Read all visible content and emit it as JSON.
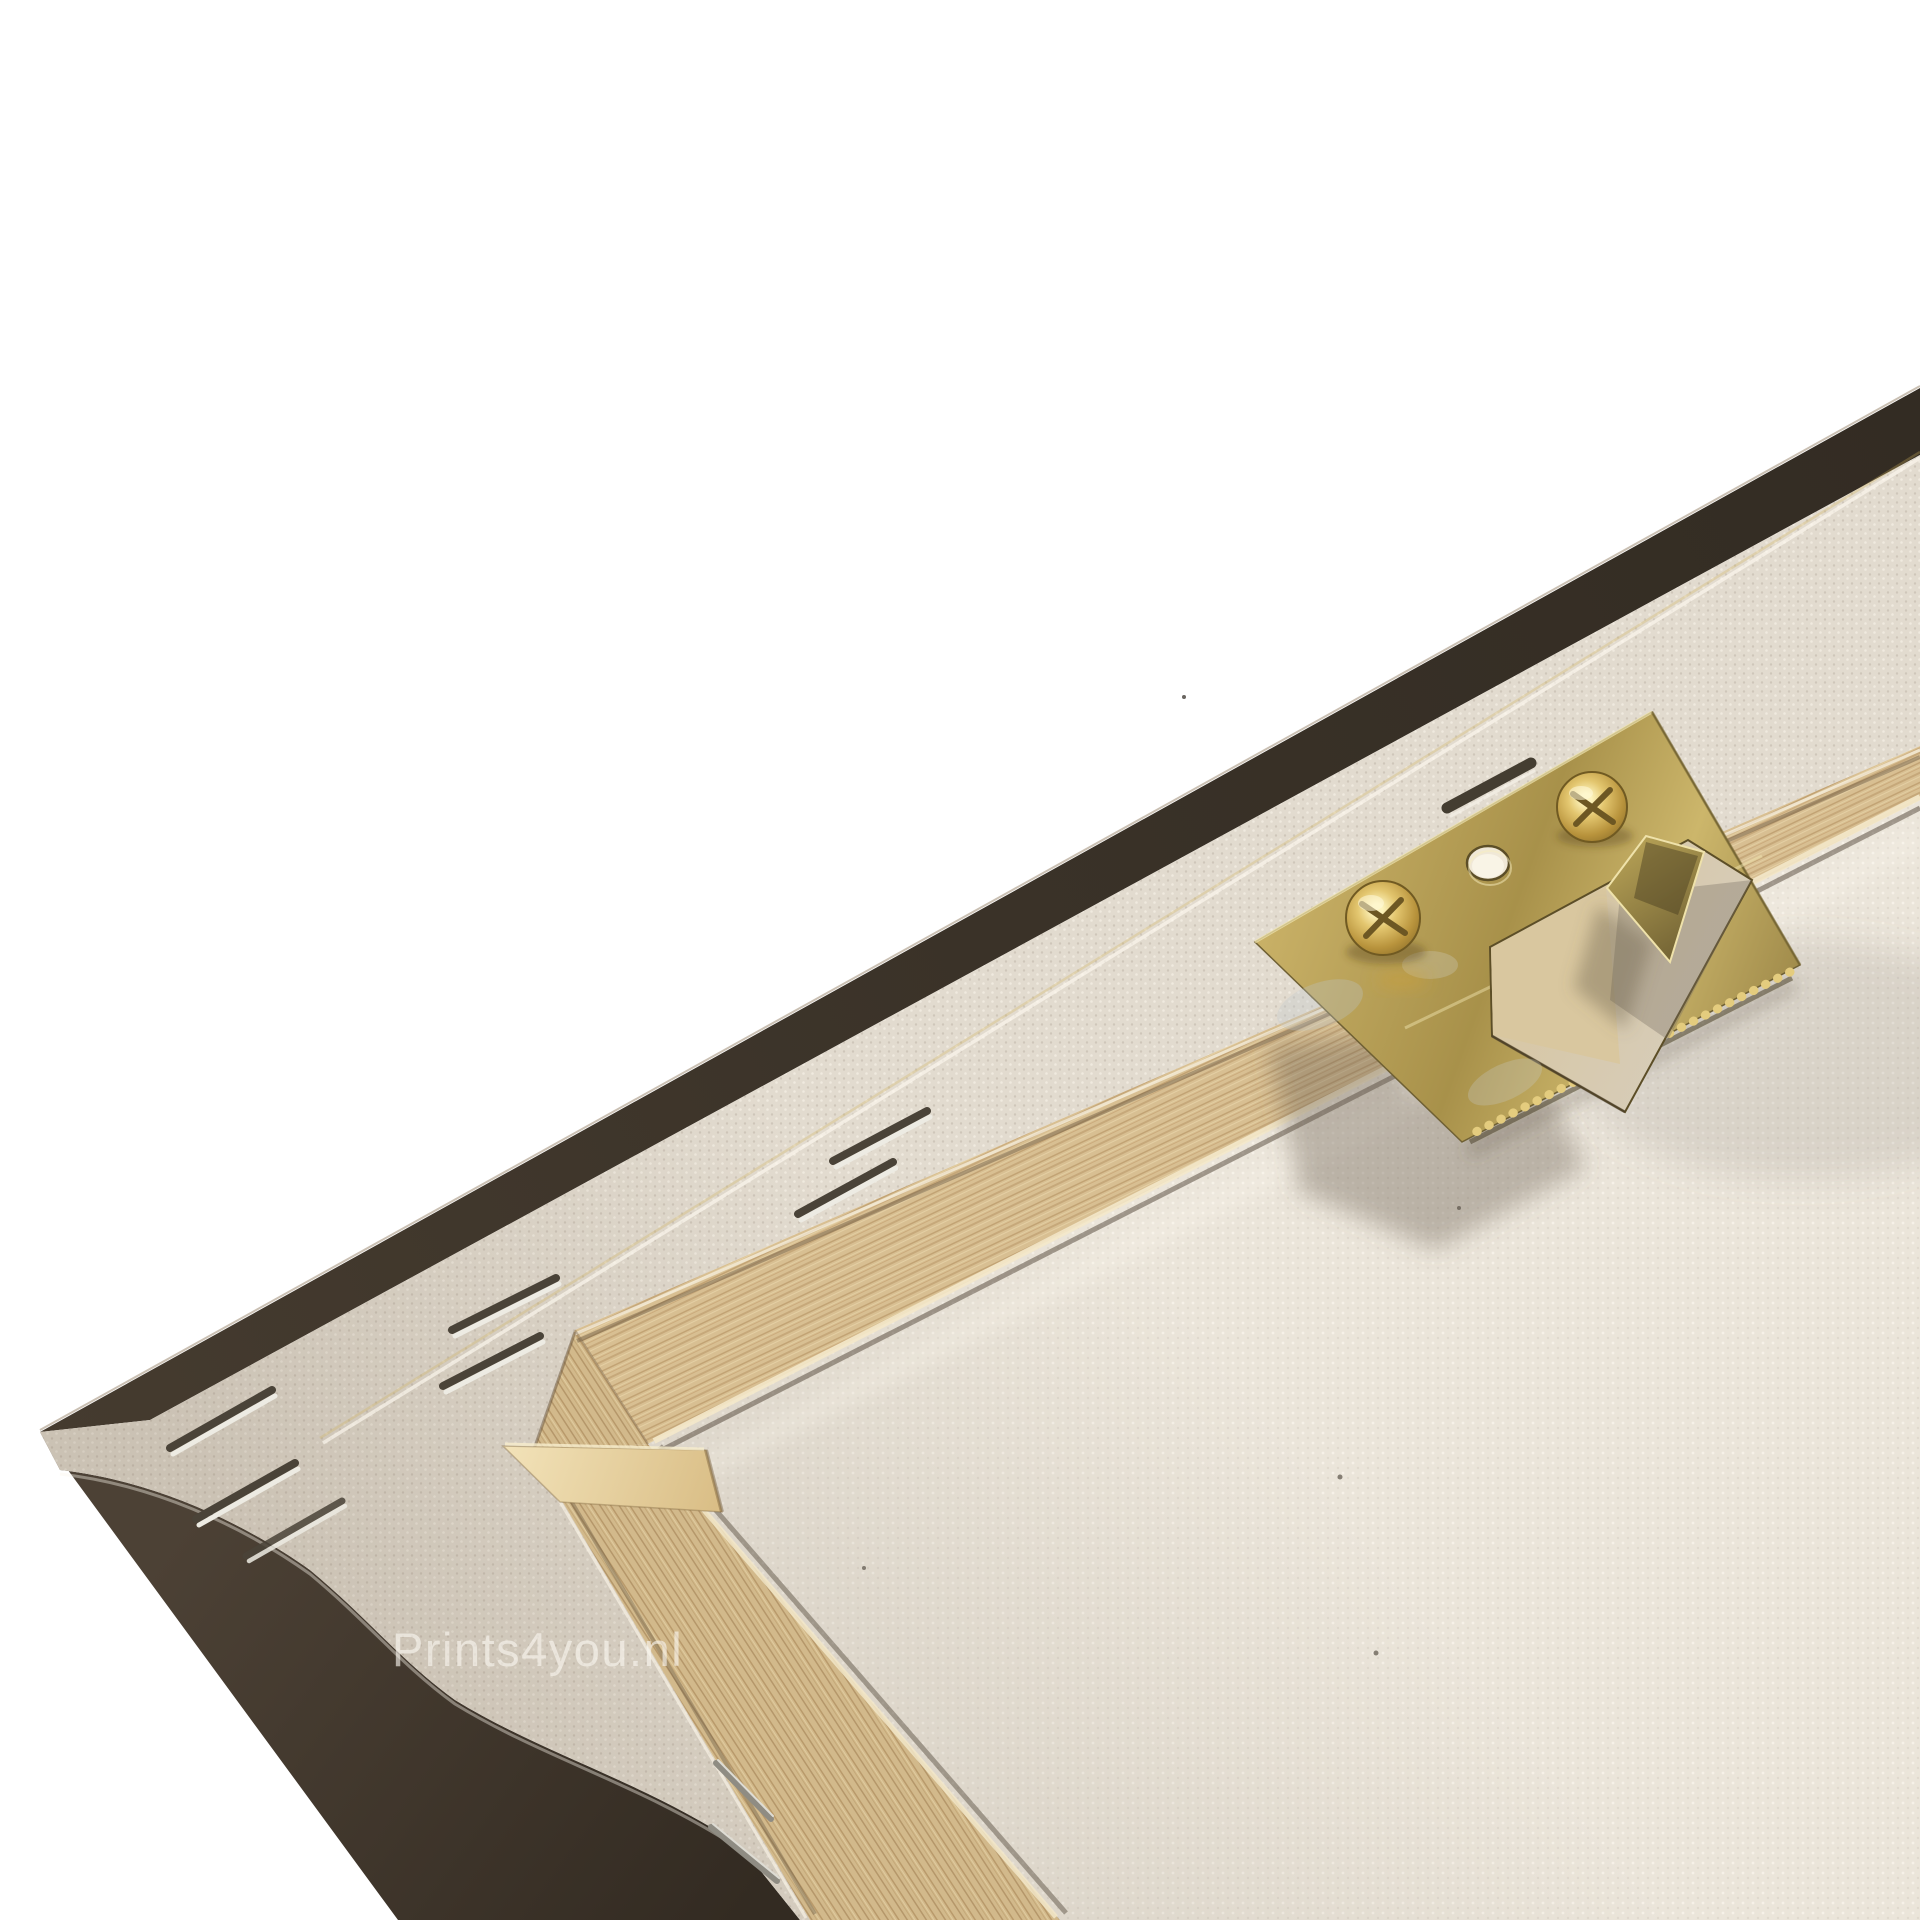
{
  "scene": {
    "description": "Close-up photo of the back corner of a stretched canvas print on a wooden stretcher frame",
    "background": "#ffffff"
  },
  "watermark": {
    "text": "Prints4you.nl",
    "color": "rgba(250,247,240,0.62)"
  },
  "palette": {
    "canvas_edge_dark": "#3a322a",
    "canvas_back_band": "#e2dbcf",
    "canvas_interior": "#ebe5da",
    "wood_top_bar": "#d8bf92",
    "wood_left_bar": "#d2b98b",
    "bracket_brass": "#b0984f",
    "screw_gold": "#e3c66f",
    "staple_metal": "#edebe3",
    "shadow": "#69604f"
  },
  "hardware": {
    "bracket_type": "sawtooth-hanger",
    "screw_count": 2,
    "empty_hole_count": 1,
    "staples_visible": 7,
    "loose_pins_visible": 2
  }
}
